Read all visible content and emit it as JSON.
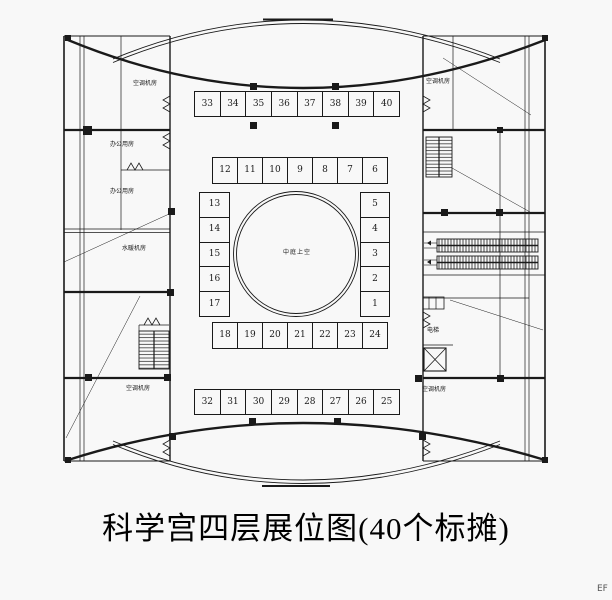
{
  "title": "科学宫四层展位图(40个标摊)",
  "corner_mark": "EF",
  "atrium": {
    "label": "中庭上空"
  },
  "booths": {
    "top_row": [
      "33",
      "34",
      "35",
      "36",
      "37",
      "38",
      "39",
      "40"
    ],
    "upper_inner_row": [
      "12",
      "11",
      "10",
      "9",
      "8",
      "7",
      "6"
    ],
    "left_column": [
      "13",
      "14",
      "15",
      "16",
      "17"
    ],
    "right_column": [
      "5",
      "4",
      "3",
      "2",
      "1"
    ],
    "lower_inner_row": [
      "18",
      "19",
      "20",
      "21",
      "22",
      "23",
      "24"
    ],
    "bottom_row": [
      "32",
      "31",
      "30",
      "29",
      "28",
      "27",
      "26",
      "25"
    ]
  },
  "rooms": {
    "left_top": "空调机房",
    "left_mid_a": "办公用房",
    "left_mid_b": "办公用房",
    "left_mid_c": "水暖机房",
    "left_bottom": "空调机房",
    "right_top": "空调机房",
    "right_elevator": "电梯",
    "right_bottom": "空调机房"
  },
  "features": {
    "stair_top_right": "staircase",
    "stair_bottom_left": "staircase",
    "elevator_shaft": "elevator",
    "escalator": "escalator",
    "atrium_void": "circular atrium opening"
  },
  "colors": {
    "background": "#f8f8f8",
    "line": "#1a1a1a",
    "corner_mark_grey": "#555555"
  },
  "booth_count": "40"
}
